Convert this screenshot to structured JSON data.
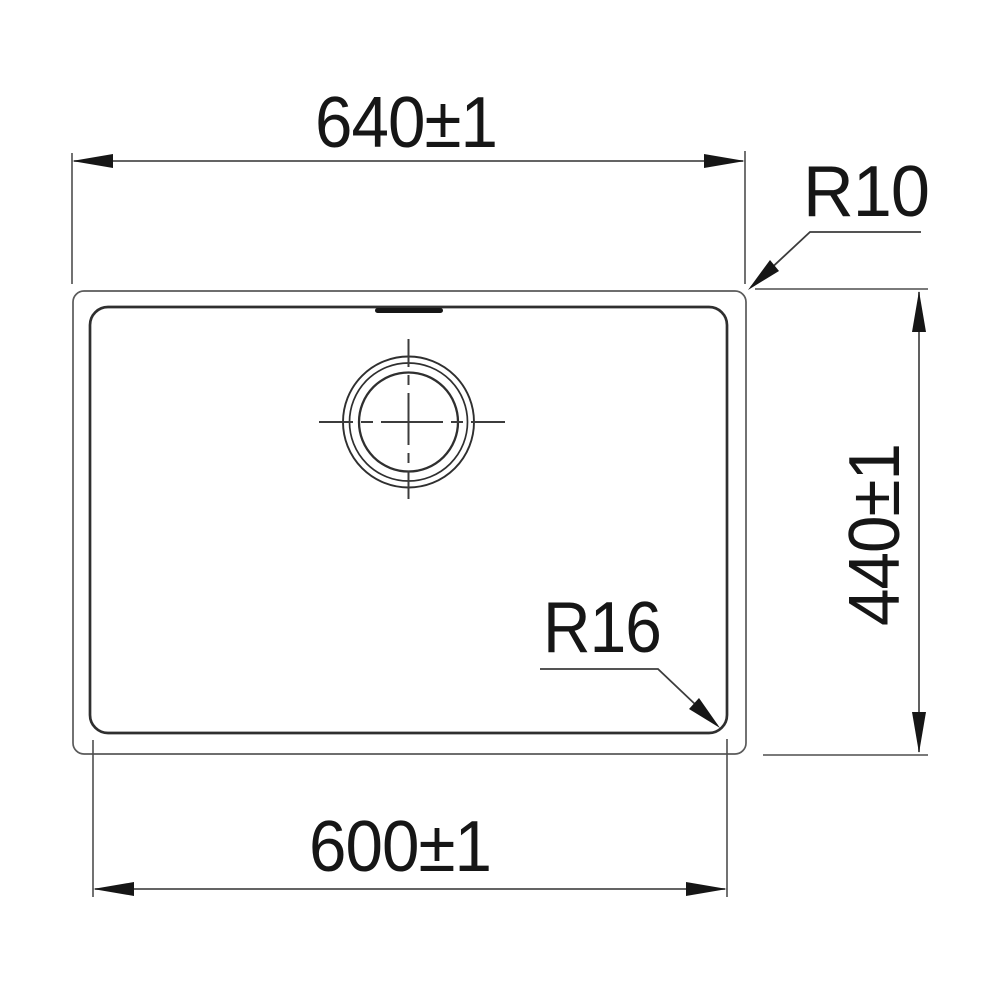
{
  "drawing": {
    "type": "technical-dimension-drawing",
    "labels": {
      "top_width": "640±1",
      "side_height": "440±1",
      "bottom_width": "600±1",
      "outer_corner_radius": "R10",
      "inner_corner_radius": "R16"
    },
    "colors": {
      "background": "#ffffff",
      "outline": "#2f2f2f",
      "dimension_lines": "#4e4e4e",
      "text": "#161616"
    }
  }
}
